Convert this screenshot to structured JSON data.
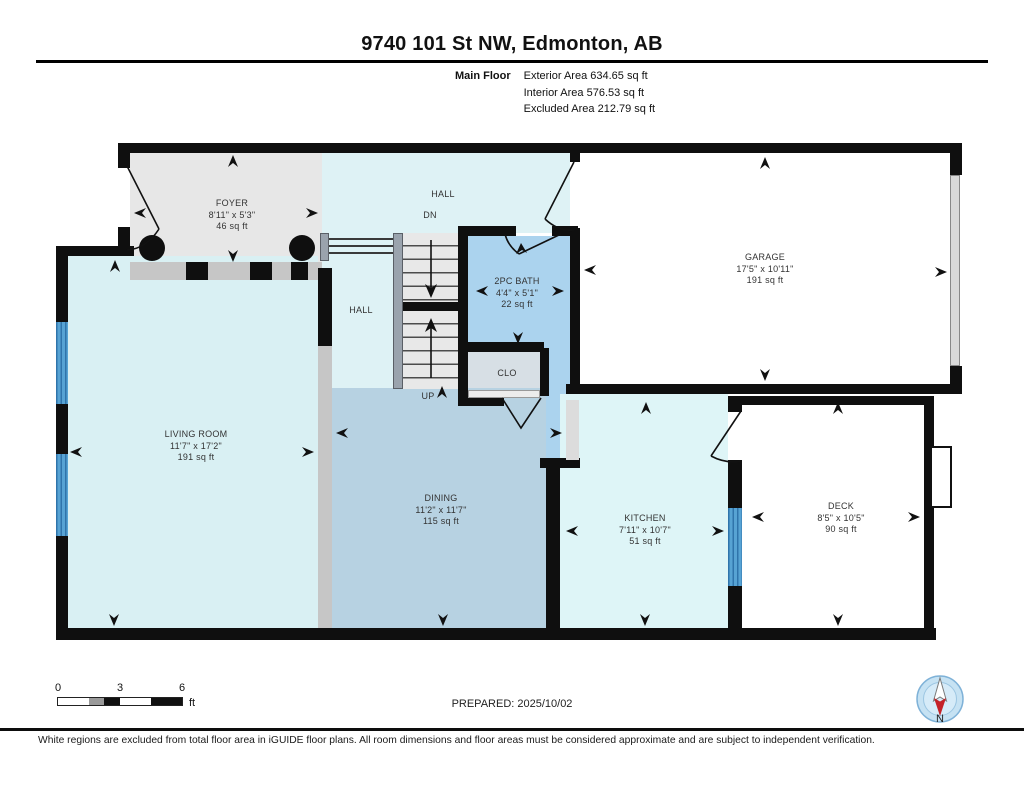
{
  "header": {
    "title": "9740 101 St NW, Edmonton, AB",
    "floor_label": "Main Floor",
    "stats": [
      "Exterior Area 634.65 sq ft",
      "Interior Area 576.53 sq ft",
      "Excluded Area 212.79 sq ft"
    ]
  },
  "rooms": {
    "foyer": {
      "name": "FOYER",
      "dims": "8'11\" x 5'3\"",
      "area": "46 sq ft"
    },
    "hall_upper": {
      "name": "HALL"
    },
    "stair_down": {
      "label": "DN"
    },
    "garage": {
      "name": "GARAGE",
      "dims": "17'5\" x 10'11\"",
      "area": "191 sq ft"
    },
    "bath": {
      "name": "2PC BATH",
      "dims": "4'4\" x 5'1\"",
      "area": "22 sq ft"
    },
    "hall_lower": {
      "name": "HALL"
    },
    "closet": {
      "name": "CLO"
    },
    "stair_up": {
      "label": "UP"
    },
    "living": {
      "name": "LIVING ROOM",
      "dims": "11'7\" x 17'2\"",
      "area": "191 sq ft"
    },
    "dining": {
      "name": "DINING",
      "dims": "11'2\" x 11'7\"",
      "area": "115 sq ft"
    },
    "kitchen": {
      "name": "KITCHEN",
      "dims": "7'11\" x 10'7\"",
      "area": "51 sq ft"
    },
    "deck": {
      "name": "DECK",
      "dims": "8'5\" x 10'5\"",
      "area": "90 sq ft"
    }
  },
  "scale_bar": {
    "ticks": [
      "0",
      "3",
      "6"
    ],
    "unit": "ft"
  },
  "prepared": "PREPARED: 2025/10/02",
  "compass": {
    "north_label": "N"
  },
  "disclaimer": "White regions are excluded from total floor area in iGUIDE floor plans. All room dimensions and floor areas must be considered approximate and are subject to independent verification.",
  "colors": {
    "wall": "#0f0f0f",
    "hall_cyan": "#def2f5",
    "living_cyan": "#d9f0f3",
    "kitchen_cyan": "#def5f7",
    "dining_blue": "#b7d2e2",
    "bath_blue": "#abd3ee",
    "closet_gray": "#d7dfe5",
    "foyer_gray": "#e7e7e7",
    "window_blue": "#57a3d4",
    "excluded_white": "#ffffff",
    "compass_red": "#c42127"
  }
}
